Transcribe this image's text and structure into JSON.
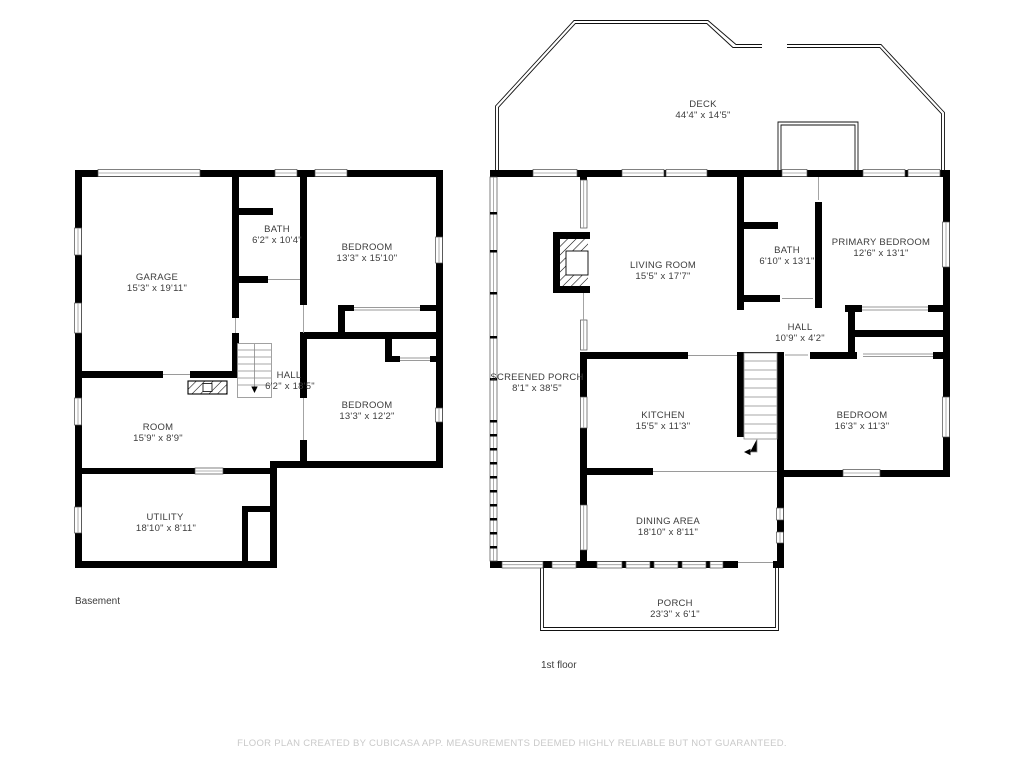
{
  "footer": "FLOOR PLAN CREATED BY CUBICASA APP. MEASUREMENTS DEEMED HIGHLY RELIABLE BUT NOT GUARANTEED.",
  "colors": {
    "wall": "#000000",
    "room_text": "#3c3c3c",
    "footer_text": "#c9c9c9",
    "thin_line": "#9a9a9a",
    "background": "#ffffff"
  },
  "floors": {
    "basement": {
      "label": "Basement",
      "rooms": [
        {
          "name": "GARAGE",
          "dims": "15'3\" x 19'11\""
        },
        {
          "name": "BATH",
          "dims": "6'2\" x 10'4\""
        },
        {
          "name": "BEDROOM",
          "dims": "13'3\" x 15'10\""
        },
        {
          "name": "HALL",
          "dims": "6'2\" x 18'5\""
        },
        {
          "name": "ROOM",
          "dims": "15'9\" x 8'9\""
        },
        {
          "name": "BEDROOM",
          "dims": "13'3\" x 12'2\""
        },
        {
          "name": "UTILITY",
          "dims": "18'10\" x 8'11\""
        }
      ]
    },
    "first": {
      "label": "1st floor",
      "rooms": [
        {
          "name": "DECK",
          "dims": "44'4\" x 14'5\""
        },
        {
          "name": "LIVING ROOM",
          "dims": "15'5\" x 17'7\""
        },
        {
          "name": "BATH",
          "dims": "6'10\" x 13'1\""
        },
        {
          "name": "PRIMARY BEDROOM",
          "dims": "12'6\" x 13'1\""
        },
        {
          "name": "HALL",
          "dims": "10'9\" x 4'2\""
        },
        {
          "name": "SCREENED PORCH",
          "dims": "8'1\" x 38'5\""
        },
        {
          "name": "KITCHEN",
          "dims": "15'5\" x 11'3\""
        },
        {
          "name": "BEDROOM",
          "dims": "16'3\" x 11'3\""
        },
        {
          "name": "DINING AREA",
          "dims": "18'10\" x 8'11\""
        },
        {
          "name": "PORCH",
          "dims": "23'3\" x 6'1\""
        }
      ]
    }
  }
}
